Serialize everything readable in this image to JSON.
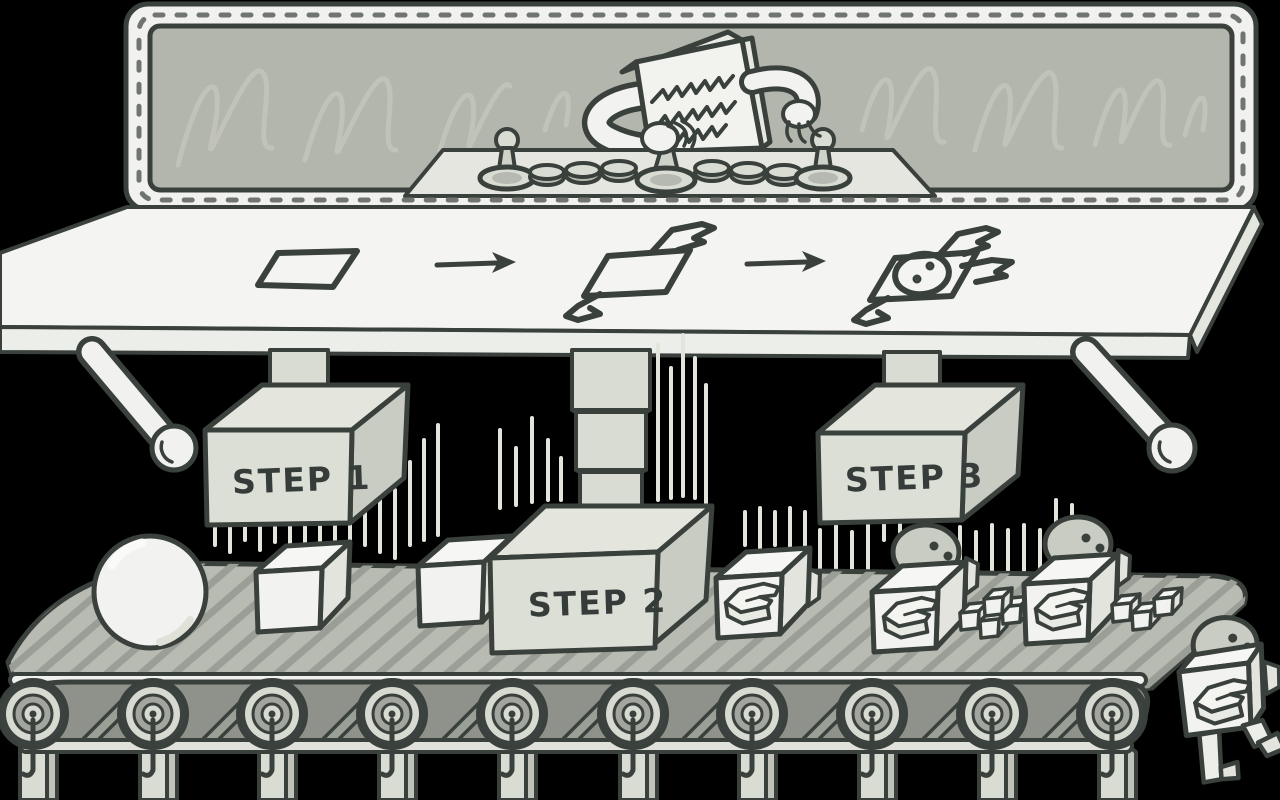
{
  "scene": {
    "title": "Robot assembly line illustration",
    "steps": [
      {
        "label": "STEP 1"
      },
      {
        "label": "STEP 2"
      },
      {
        "label": "STEP 3"
      }
    ],
    "process_sequence": {
      "stage1": "flat-sheet",
      "arrow": "right-arrow",
      "stage2": "folding-sheet",
      "stage3": "assembled-bot"
    },
    "operator": "box-headed-operator-at-control-panel",
    "controls": {
      "joysticks": 3,
      "buttons": 6
    },
    "conveyor": {
      "roller_count": 10,
      "items": [
        "sphere",
        "cube",
        "cube",
        "emblem-cube",
        "robot-with-parts",
        "robot-with-parts",
        "walking-robot"
      ]
    }
  },
  "colors": {
    "background": "#000000",
    "outline": "#3a403c",
    "paper_white": "#f2f3f0",
    "machine_gray": "#d9dcd3",
    "glass": "#b2b6ac",
    "glass_reflection": "#c3c6bb",
    "belt_top": "#b8bbb2",
    "belt_stripe": "#9a9e96",
    "belt_front": "#8e928b",
    "speed_line": "#e2e5db"
  }
}
